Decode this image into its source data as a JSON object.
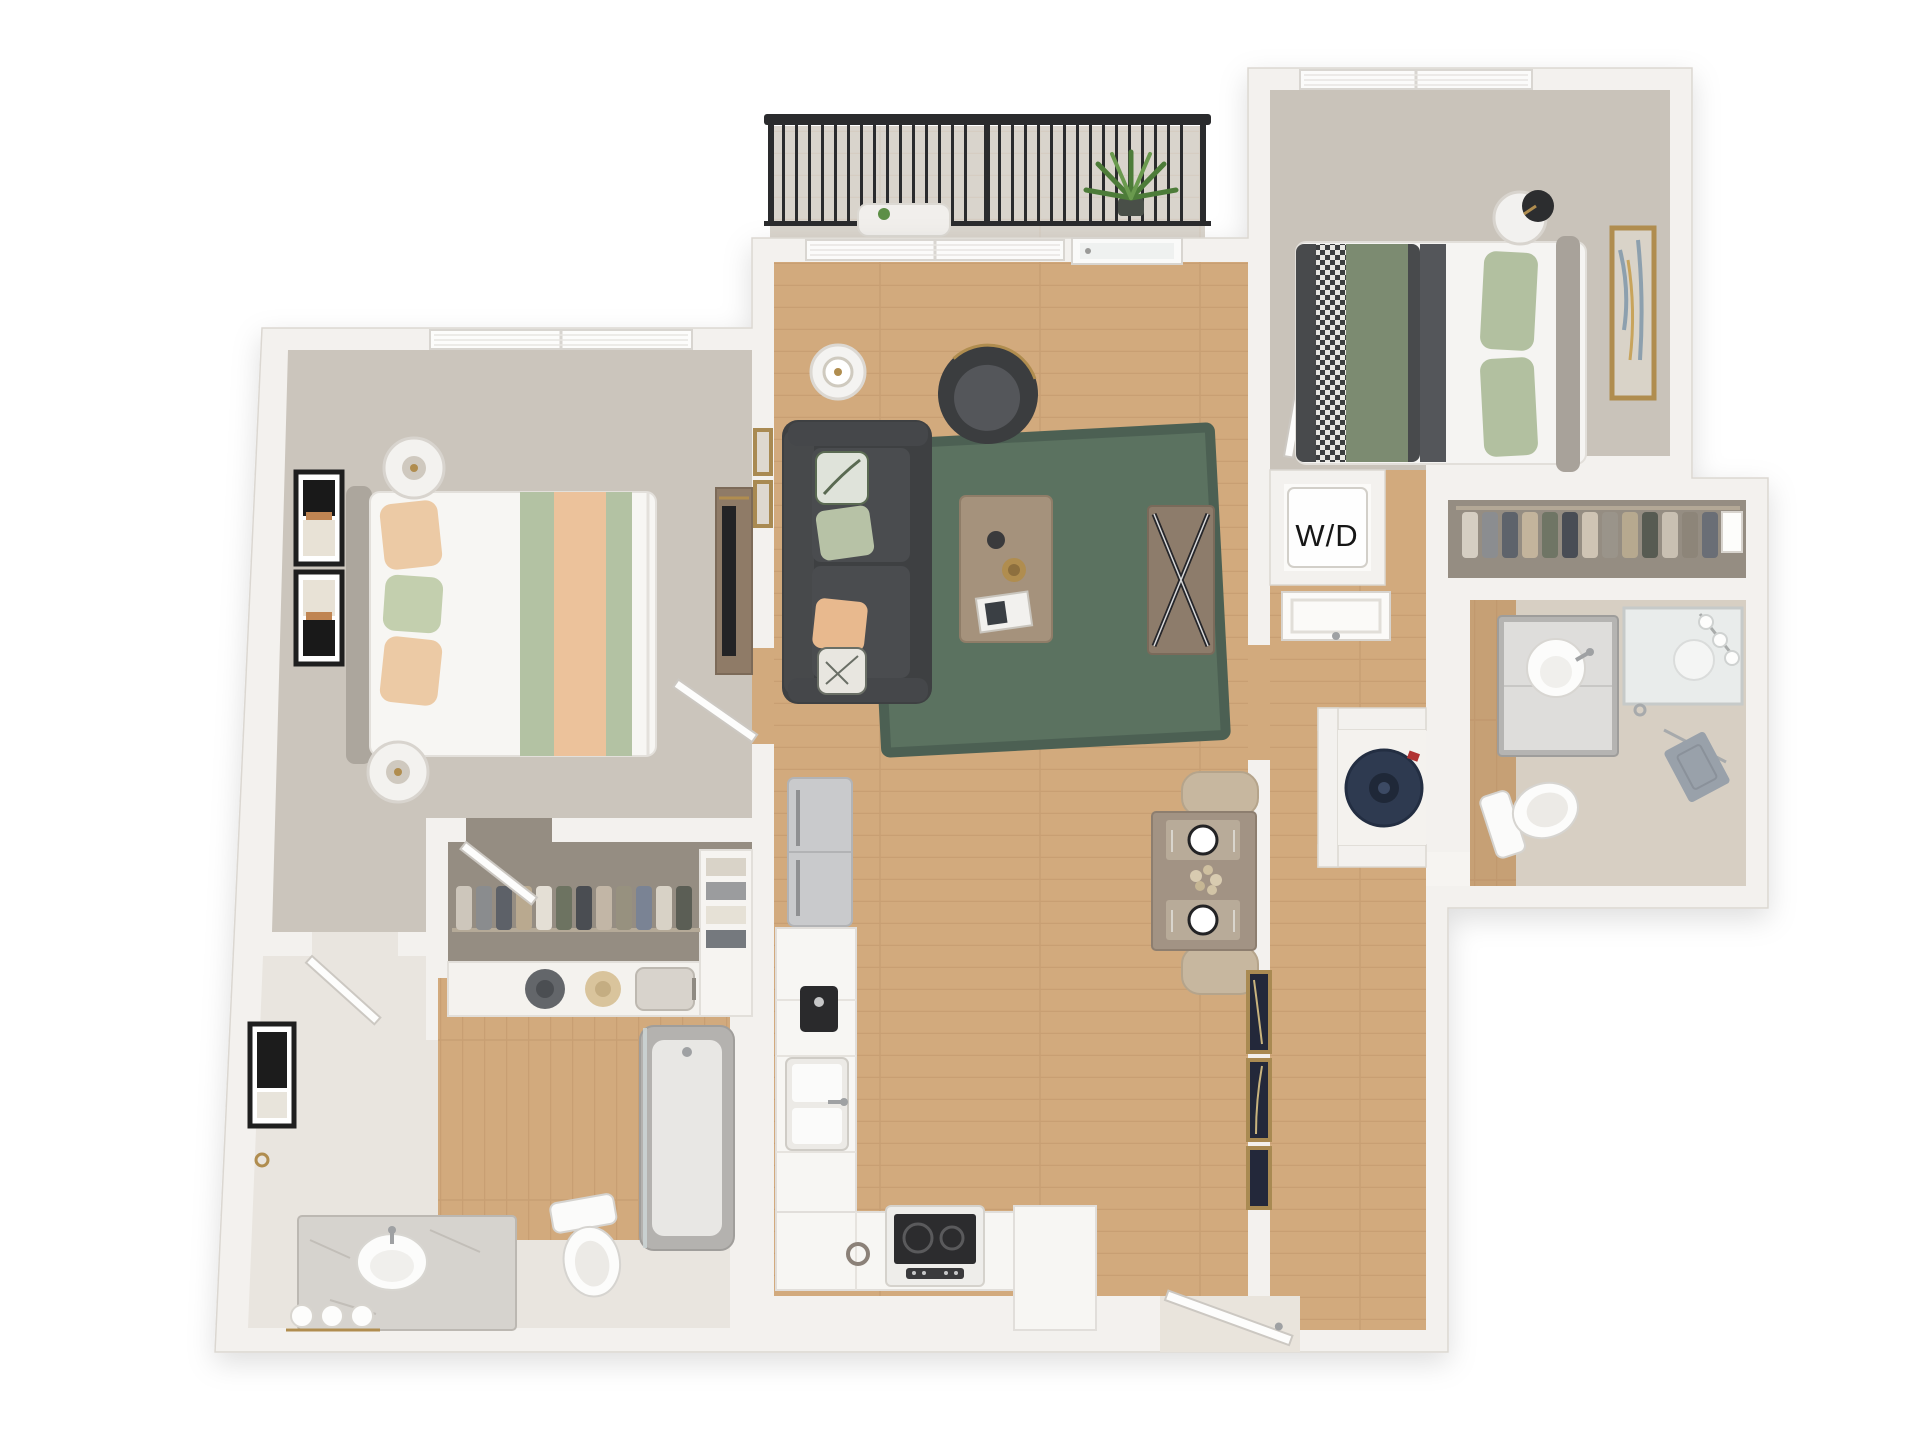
{
  "meta": {
    "type": "3d-apartment-floor-plan-rendering",
    "view": "top-down",
    "bedrooms": 2,
    "bathrooms": 2
  },
  "labels": {
    "washer_dryer": "W/D"
  },
  "palette": {
    "background": "#ffffff",
    "wall": "#f3f1ee",
    "carpet": "#c9c3ba",
    "closet_carpet": "#958d82",
    "hardwood": "#d2aa7d",
    "area_rug_green": "#5b7260",
    "sofa_charcoal": "#3f4143",
    "duvet_dark": "#484a4c",
    "accent_sage": "#b3c2a3",
    "accent_peach": "#ecc29b",
    "brass": "#b08d4f",
    "balcony_railing": "#2a2b2d",
    "water_heater_navy": "#2e3a50"
  },
  "rooms": [
    {
      "id": "balcony",
      "floor": "concrete",
      "items": [
        "metal-railing",
        "potted-plant",
        "patio-table"
      ]
    },
    {
      "id": "living-room",
      "floor": "hardwood",
      "items": [
        "sofa",
        "throw-pillows",
        "area-rug",
        "coffee-table",
        "accent-chair",
        "side-table-with-lamp",
        "media-console",
        "window",
        "balcony-door",
        "wall-art"
      ]
    },
    {
      "id": "kitchen",
      "floor": "hardwood",
      "items": [
        "refrigerator",
        "l-shaped-counter",
        "coffee-maker",
        "double-sink",
        "range-stove",
        "peninsula-cabinet"
      ]
    },
    {
      "id": "dining-nook",
      "floor": "hardwood",
      "items": [
        "dining-table",
        "two-upholstered-chairs",
        "place-settings",
        "floral-centerpiece"
      ]
    },
    {
      "id": "bedroom-1",
      "floor": "carpet",
      "items": [
        "bed",
        "tufted-headboard",
        "striped-runner-blanket",
        "pillows",
        "two-nightstand-lamps",
        "gallery-wall-art",
        "window",
        "dresser-with-tv"
      ]
    },
    {
      "id": "walk-in-closet-1",
      "floor": "carpet",
      "items": [
        "hanging-clothes",
        "hats",
        "suitcase",
        "shelving",
        "door"
      ]
    },
    {
      "id": "bathroom-1",
      "floor": "hardwood",
      "items": [
        "marble-vanity-sink",
        "toilet",
        "bathtub-shower",
        "wall-art",
        "rolled-towels",
        "door"
      ]
    },
    {
      "id": "bedroom-2",
      "floor": "carpet",
      "items": [
        "bed",
        "dark-duvet",
        "green-blanket",
        "checkered-throw",
        "green-pillows",
        "round-side-table",
        "black-lamp",
        "wall-art",
        "window",
        "door"
      ]
    },
    {
      "id": "walk-in-closet-2",
      "floor": "carpet",
      "items": [
        "hanging-clothes",
        "storage-boxes",
        "closet-rod"
      ]
    },
    {
      "id": "bathroom-2",
      "floor": "tile-and-hardwood",
      "items": [
        "vanity-sink",
        "mirror",
        "sconce-lights",
        "toilet",
        "hand-towel"
      ]
    },
    {
      "id": "laundry-closet",
      "label_key": "washer_dryer",
      "items": [
        "stacked-washer-dryer",
        "paneled-doors"
      ]
    },
    {
      "id": "utility-closet",
      "items": [
        "water-heater"
      ]
    },
    {
      "id": "entry-hall",
      "floor": "hardwood",
      "items": [
        "gallery-frames",
        "front-door"
      ]
    }
  ]
}
